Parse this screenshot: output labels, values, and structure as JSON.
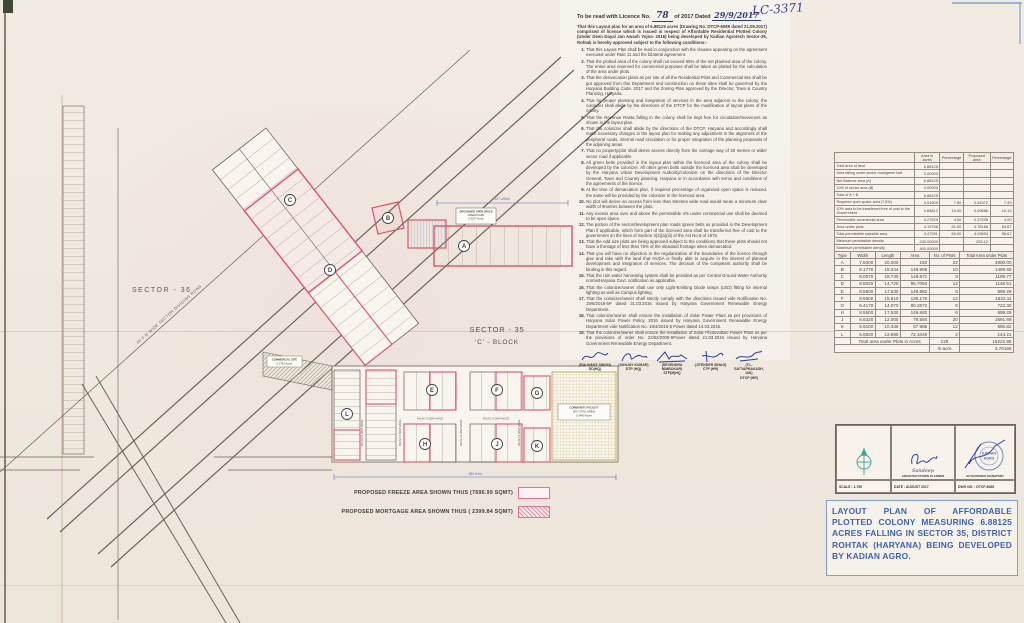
{
  "colors": {
    "plan_red": "#d9556b",
    "ink_blue": "#2b3f9e",
    "title_blue": "#3d63b5",
    "legend_pink": "#e8718d"
  },
  "handwritten": {
    "file_no": "LC-3371",
    "licence_no": "78",
    "licence_date": "29/9/2017"
  },
  "licence": {
    "head_prefix": "To be read with Licence No.",
    "head_mid": "of 2017 Dated",
    "intro": "That this Layout plan for an area of 6.88125 acres (Drawing No. DTCP-6089 dated 21.09.2017) comprised of licence which is issued in respect of Affordable Residential Plotted Colony (Under Deen Dayal Jan Awash Yojna- 2016) being developed by Kadian Agrotech Sector-35, Rohtak is hereby approved subject to the following conditions:-",
    "conditions": [
      "That this Layout Plan shall be read in conjunction with the clauses appearing on the agreement executed under Rule 11 and the bilateral agreement.",
      "That the plotted area of the colony shall not exceed 65% of the net planned area of the colony. The entire area reserved for commercial purposes shall be taken as plotted for the calculation of the area under plots.",
      "That the demarcation plans as per site of all the Residential Plots and Commercial site shall be got approved from this Department and construction on these sites shall be governed by the Haryana Building Code, 2017 and the Zoning Plan approved by the Director, Town & Country Planning, Haryana.",
      "That for proper planning and integration of services in the area adjacent to the colony, the colonizer shall abide by the directions of the DTCP for the modification of layout plans of the colony.",
      "That the Revenue Rasta falling in the colony shall be kept free for circulation/movement as shown in the layout plan.",
      "That the colonizer shall abide by the directions of the DTCP, Haryana and accordingly shall make necessary changes in the layout plan for making any adjustment in the alignment of the peripheral roads, internal road circulation or for proper integration of the planning proposals of the adjoining areas.",
      "That no property/plot shall derive access directly from the carriage way of 30 metres or wider sector road if applicable.",
      "All green belts provided in the layout plan within the licenced area of the colony shall be developed by the colonizer. All other green belts outside the licenced area shall be developed by the Haryana Urban Development Authority/colonizer on the directions of the Director General, Town and Country planning, Haryana or in accordance with terms and conditions of the agreements of the licence.",
      "At the time of demarcation plan, if required percentage of organised open space is reduced, the same will be provided by the colonizer in the licenced area.",
      "No plot will derive an access from less than 9metres wide road would mean a minimum clear width of 9metres between the plots.",
      "Any excess area over and above the permissible 4% under commercial use shall be deemed to be open space.",
      "The portion of the sector/development plan roads /green belts as provided in the Development Plan if applicable, which form part of the licenced area shall be transferred free of cost to the government on the lines of Section 3(3)(a)(iii) of the Act No.8 of 1975.",
      "That the odd size plots are being approved subject to the conditions that these plots should not have a frontage of less than 75% of the standard frontage when demarcated.",
      "That you will have no objection to the regularization of the boundaries of the licence through give and take with the land that HUDA is finally able to acquire in the interest of planned development and integration of services. The decision of the competent authority shall be binding in this regard.",
      "That the rain water harvesting system shall be provided as per Central Ground Water Authority norms/Haryana Govt. notification as applicable.",
      "That the colonizer/owner shall use only Light-Emitting Diode lamps (LED) fitting for internal lighting as well as Campus lighting.",
      "That the colonizer/owner shall strictly comply with the directions issued vide Notification No. 19/6/2016-5P dated 31.03.2016 issued by Haryana Government Renewable Energy Department.",
      "That colonizer/owner shall ensure the installation of Solar Power Plant as per provisions of Haryana Solar Power Policy, 2016 issued by Haryana Government Renewable Energy Department vide Notification No. 19/4/2016-5 Power dated 14.03.2016.",
      "That the colonizer/owner shall ensure the installation of Solar Photovoltaic Power Plant as per the provisions of order No. 22/52/2005-5Power dated 21.03.2016 issued by Haryana Government Renewable Energy Department."
    ]
  },
  "signatures": [
    {
      "name": "(BALWANT SINGH)",
      "desig": "DD(HQ)"
    },
    {
      "name": "(SANJAY KUMAR)",
      "desig": "DTP (HQ)"
    },
    {
      "name": "(DEVENDRA NIMBOKAR)",
      "desig": "STP(M)HQ"
    },
    {
      "name": "(JITENDER SIHAG)",
      "desig": "CTP (HR)"
    },
    {
      "name": "(T.L. SATYAPRAKASH, IAS)",
      "desig": "DTCP (HR)"
    }
  ],
  "area_table": {
    "headers": [
      "",
      "Area in acres",
      "Percentage",
      "Proposed area",
      "Percentage"
    ],
    "rows": [
      [
        "Total area of land",
        "6.88125",
        "",
        "",
        ""
      ],
      [
        "Area falling under sector road/green belt",
        "0.00000",
        "",
        "",
        ""
      ],
      [
        "Net Balance area (A)",
        "6.88125",
        "",
        "",
        ""
      ],
      [
        "10% of sector area (B)",
        "0.00000",
        "",
        "",
        ""
      ],
      [
        "Total of A + B",
        "6.88125",
        "",
        "",
        ""
      ],
      [
        "Required open space area (7.5%)",
        "0.51609",
        "7.50",
        "0.51572",
        "7.49"
      ],
      [
        "10% area to be transferred free of cost to the Government",
        "0.68812",
        "10.00",
        "0.69686",
        "10.13"
      ],
      [
        "Permissible commercial area",
        "0.27525",
        "4.00",
        "0.27525",
        "4.00"
      ],
      [
        "Area under plots",
        "4.19756",
        "61.00",
        "3.76168",
        "54.67"
      ],
      [
        "Total permissible saleable area",
        "4.47281",
        "65.00",
        "4.03694",
        "58.67"
      ],
      [
        "Minimum permissible density",
        "240.00000",
        "",
        "253.12",
        ""
      ],
      [
        "Maximum permissible density",
        "400.00000",
        "",
        "",
        ""
      ]
    ]
  },
  "plot_table": {
    "headers": [
      "Type",
      "Width",
      "Length",
      "Area",
      "No. of Plots",
      "Total Area under Plots"
    ],
    "rows": [
      [
        "A",
        "7.5000",
        "20.000",
        "150",
        "32",
        "4800.00"
      ],
      [
        "B",
        "8.1770",
        "18.344",
        "149.999",
        "10",
        "1499.99"
      ],
      [
        "C",
        "8.0070",
        "18.730",
        "149.971",
        "8",
        "1199.77"
      ],
      [
        "D",
        "6.5020",
        "14.720",
        "95.7094",
        "12",
        "1148.51"
      ],
      [
        "E",
        "8.5500",
        "17.530",
        "149.882",
        "6",
        "899.29"
      ],
      [
        "F",
        "8.5500",
        "15.810",
        "135.176",
        "12",
        "1622.11"
      ],
      [
        "G",
        "6.4170",
        "14.070",
        "90.2872",
        "8",
        "722.30"
      ],
      [
        "H",
        "8.5500",
        "17.530",
        "149.882",
        "6",
        "899.29"
      ],
      [
        "J",
        "6.6320",
        "12.000",
        "79.584",
        "20",
        "1591.68"
      ],
      [
        "K",
        "5.6100",
        "10.336",
        "57.985",
        "12",
        "695.82"
      ],
      [
        "L",
        "5.6820",
        "12.690",
        "72.1046",
        "2",
        "144.21"
      ]
    ],
    "total_label": "Total area under Plots in Acres",
    "total_plots": "128",
    "total_area": "15222.96",
    "in_acre_label": "In acre",
    "in_acre_value": "3.76168"
  },
  "title_block": {
    "scale": "SCALE : 1:750",
    "architect_label": "ARCHITECT/TOWN PLANNER",
    "architect_hand": "Sandeep",
    "date": "DATE : AUGUST 2017",
    "signatory_label": "AUTHORISED SIGNATORY",
    "dwg": "DWG NO. : DTCP-6089",
    "stamp_line1": "KADIAN",
    "stamp_line2": "AGRO"
  },
  "main_title": "LAYOUT PLAN OF AFFORDABLE PLOTTED COLONY MEASURING 6.88125 ACRES FALLING IN SECTOR 35, DISTRICT ROHTAK (HARYANA) BEING DEVELOPED BY KADIAN AGRO.",
  "legend": {
    "freeze": "PROPOSED FREEZE AREA SHOWN THUS (7696.99 SQMT)",
    "mortgage": "PROPOSED MORTGAGE  AREA SHOWN THUS ( 2399.84 SQMT)"
  },
  "plan": {
    "sector_36": "SECTOR - 36",
    "sector_35": "SECTOR - 35",
    "block": "'C' - BLOCK",
    "road_label": "ROAD 9.00M WIDE",
    "dividing_road_label": "60.0 M WIDE SECTOR DIVIDING ROAD",
    "green_belt_label": "GREEN BELT",
    "dim_top": "127.406m",
    "dim_bottom": "182.94m",
    "open_space_lines": [
      "ORGANISED OPEN SPACE",
      "GREEN PARK",
      "0.5157 Acres"
    ],
    "community_lines": [
      "COMMUNITY FACILITY",
      "(5% TOTAL AREA)",
      "0.3440 Acres"
    ],
    "commercial_lines": [
      "COMMERCIAL SITE",
      "0.2752 Acres"
    ],
    "markers": {
      "a": "A",
      "b": "B",
      "c": "C",
      "d": "D",
      "e": "E",
      "f": "F",
      "g": "G",
      "h": "H",
      "j": "J",
      "k": "K",
      "l": "L"
    }
  }
}
